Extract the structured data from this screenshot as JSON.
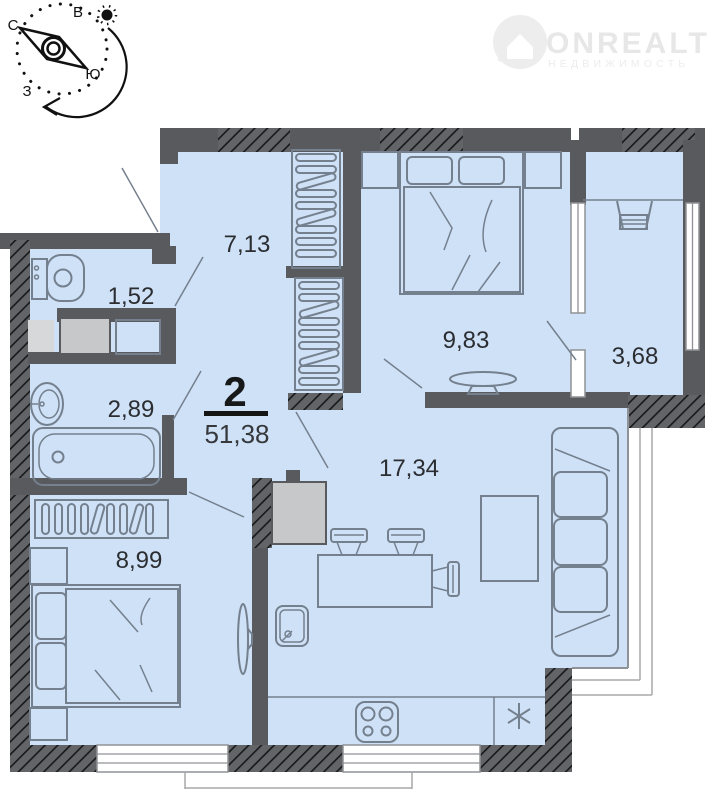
{
  "compass": {
    "north": "С",
    "east": "В",
    "south": "Ю",
    "west": "З"
  },
  "logo": {
    "brand": "ONREALT",
    "tagline": "НЕДВИЖИМОСТЬ"
  },
  "plan": {
    "summary": {
      "rooms_count": "2",
      "total_area": "51,38"
    },
    "rooms": [
      {
        "name": "hallway",
        "area": "7,13"
      },
      {
        "name": "wc",
        "area": "1,52"
      },
      {
        "name": "bathroom",
        "area": "2,89"
      },
      {
        "name": "bedroom-small",
        "area": "8,99"
      },
      {
        "name": "bedroom-main",
        "area": "9,83"
      },
      {
        "name": "loggia",
        "area": "3,68"
      },
      {
        "name": "kitchen-living",
        "area": "17,34"
      }
    ],
    "colors": {
      "room_fill": "#cee1f7",
      "wall": "#595a5d",
      "furniture": "#75808e"
    }
  }
}
